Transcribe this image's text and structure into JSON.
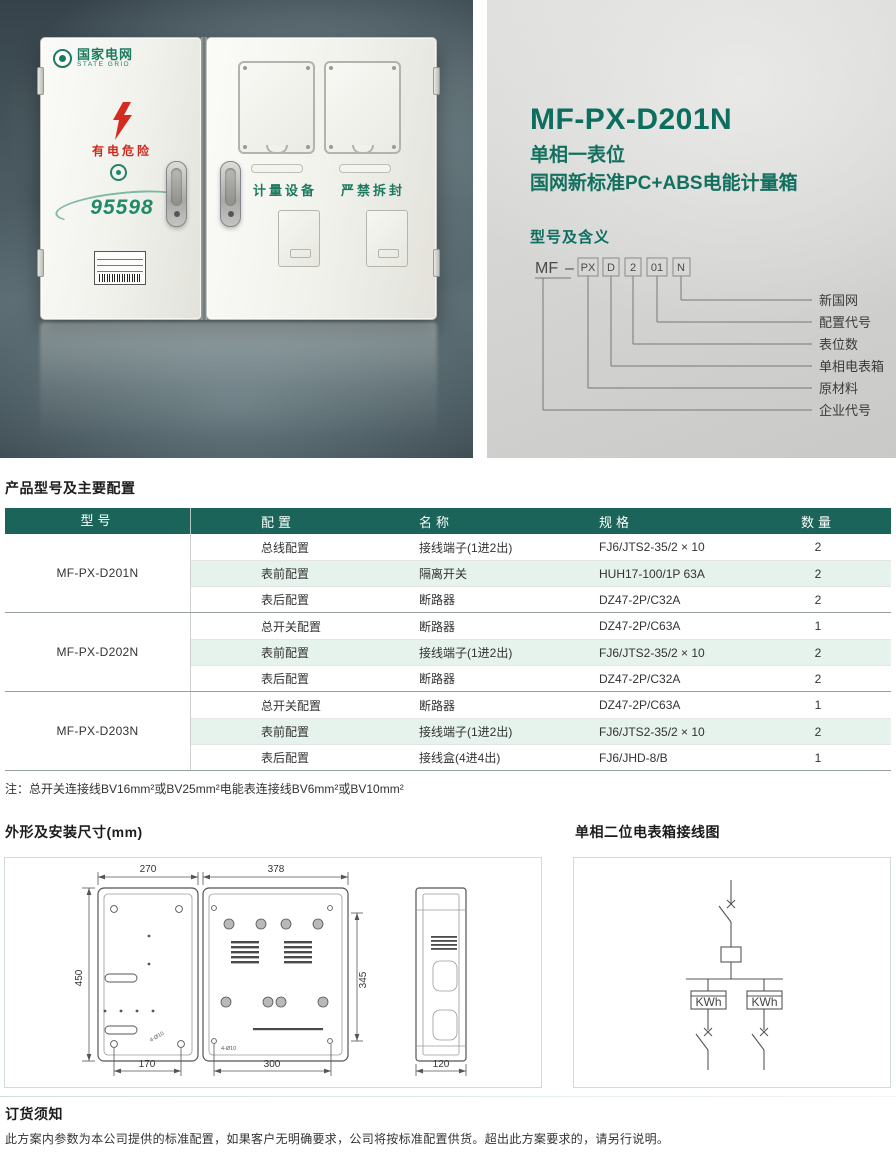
{
  "hero": {
    "photo": {
      "logo_cn": "国家电网",
      "logo_en": "STATE GRID",
      "warning": "有电危险",
      "hotline": "95598",
      "door_label_left": "计量设备",
      "door_label_right": "严禁拆封"
    },
    "info": {
      "model": "MF-PX-D201N",
      "subtitle_line1": "单相一表位",
      "subtitle_line2": "国网新标准PC+ABS电能计量箱",
      "diagram_title": "型号及含义",
      "code_prefix": "MF",
      "code_dash": "–",
      "code_boxes": [
        "PX",
        "D",
        "2",
        "01",
        "N"
      ],
      "code_labels": [
        "新国网",
        "配置代号",
        "表位数",
        "单相电表箱",
        "原材料",
        "企业代号"
      ]
    }
  },
  "config_section": {
    "title": "产品型号及主要配置",
    "table": {
      "headers": [
        "型号",
        "配置",
        "名称",
        "规格",
        "数量"
      ],
      "groups": [
        {
          "model": "MF-PX-D201N",
          "rows": [
            [
              "总线配置",
              "接线端子(1进2出)",
              "FJ6/JTS2-35/2 × 10",
              "2"
            ],
            [
              "表前配置",
              "隔离开关",
              "HUH17-100/1P 63A",
              "2"
            ],
            [
              "表后配置",
              "断路器",
              "DZ47-2P/C32A",
              "2"
            ]
          ]
        },
        {
          "model": "MF-PX-D202N",
          "rows": [
            [
              "总开关配置",
              "断路器",
              "DZ47-2P/C63A",
              "1"
            ],
            [
              "表前配置",
              "接线端子(1进2出)",
              "FJ6/JTS2-35/2 × 10",
              "2"
            ],
            [
              "表后配置",
              "断路器",
              "DZ47-2P/C32A",
              "2"
            ]
          ]
        },
        {
          "model": "MF-PX-D203N",
          "rows": [
            [
              "总开关配置",
              "断路器",
              "DZ47-2P/C63A",
              "1"
            ],
            [
              "表前配置",
              "接线端子(1进2出)",
              "FJ6/JTS2-35/2 × 10",
              "2"
            ],
            [
              "表后配置",
              "接线盒(4进4出)",
              "FJ6/JHD-8/B",
              "1"
            ]
          ]
        }
      ]
    },
    "note": "注：总开关连接线BV16mm²或BV25mm²电能表连接线BV6mm²或BV10mm²"
  },
  "dimensions_section": {
    "title": "外形及安装尺寸(mm)",
    "dims": {
      "front_width_left": "270",
      "front_width_right": "378",
      "height": "450",
      "inner_height": "345",
      "bottom_left": "170",
      "bottom_right": "300",
      "depth": "120",
      "hole_note": "4-Ø10"
    }
  },
  "wiring_section": {
    "title": "单相二位电表箱接线图",
    "meter_label": "KWh"
  },
  "order_section": {
    "title": "订货须知",
    "body": "此方案内参数为本公司提供的标准配置，如果客户无明确要求，公司将按标准配置供货。超出此方案要求的，请另行说明。"
  },
  "colors": {
    "brand_teal": "#0d6e60",
    "table_header_bg": "#1a6459",
    "row_alt_bg": "#e6f2ec",
    "warning_red": "#cc2a1d",
    "logo_green": "#1c7a5f"
  }
}
